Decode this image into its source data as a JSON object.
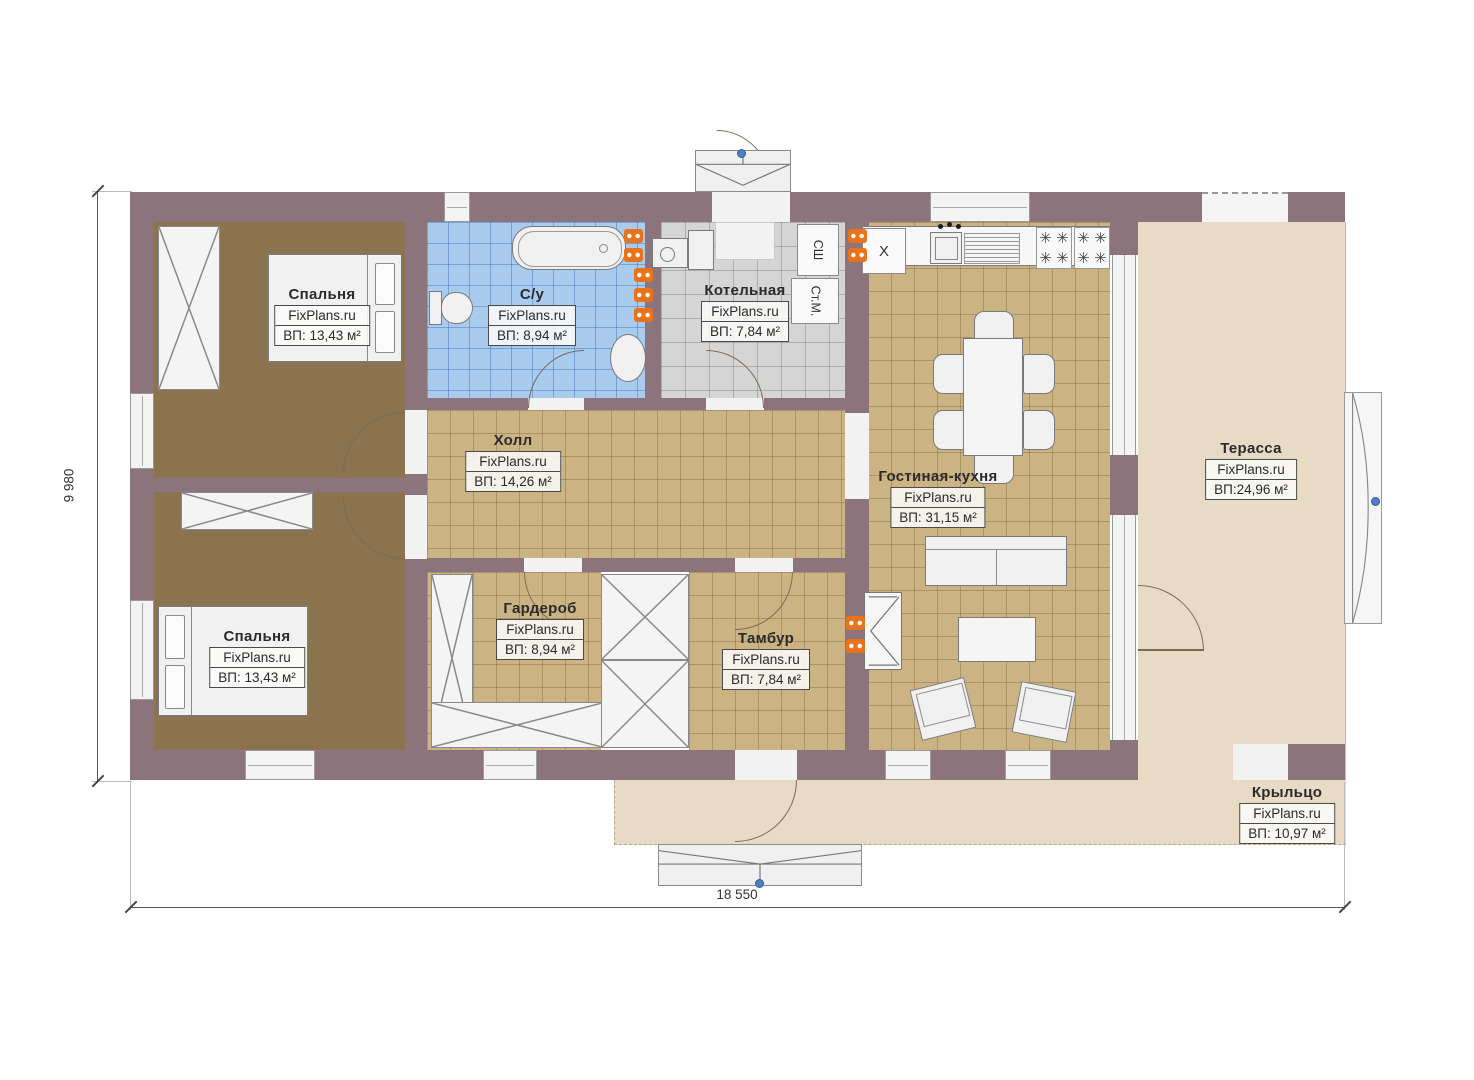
{
  "plan": {
    "watermark": "FixPlans.ru",
    "rooms": [
      {
        "key": "bedroom-1",
        "name": "Спальня",
        "area": "ВП: 13,43 м²"
      },
      {
        "key": "bathroom",
        "name": "С/у",
        "area": "ВП: 8,94 м²"
      },
      {
        "key": "boiler-room",
        "name": "Котельная",
        "area": "ВП: 7,84 м²"
      },
      {
        "key": "hall",
        "name": "Холл",
        "area": "ВП: 14,26 м²"
      },
      {
        "key": "bedroom-2",
        "name": "Спальня",
        "area": "ВП: 13,43 м²"
      },
      {
        "key": "wardrobe",
        "name": "Гардероб",
        "area": "ВП: 8,94 м²"
      },
      {
        "key": "vestibule",
        "name": "Тамбур",
        "area": "ВП: 7,84 м²"
      },
      {
        "key": "living-kitchen",
        "name": "Гостиная-кухня",
        "area": "ВП: 31,15 м²"
      },
      {
        "key": "terrace",
        "name": "Терасса",
        "area": "ВП:24,96 м²"
      },
      {
        "key": "porch",
        "name": "Крыльцо",
        "area": "ВП: 10,97 м²"
      }
    ],
    "equipment": {
      "drying_cabinet": "СШ",
      "washing_machine": "Ст.М.",
      "fridge_mark": "X"
    },
    "dimensions": {
      "overall_width": "18 550",
      "overall_height": "9 980"
    },
    "colors": {
      "wall": "#8b747b",
      "bedroom_floor": "#8a734e",
      "tile_tan": "#cbb383",
      "tile_blue": "#a9cbee",
      "tile_gray": "#d5d5d5",
      "outdoor_floor": "#e7dbc6",
      "radiator": "#e8731a",
      "marker": "#4d80c0"
    }
  }
}
